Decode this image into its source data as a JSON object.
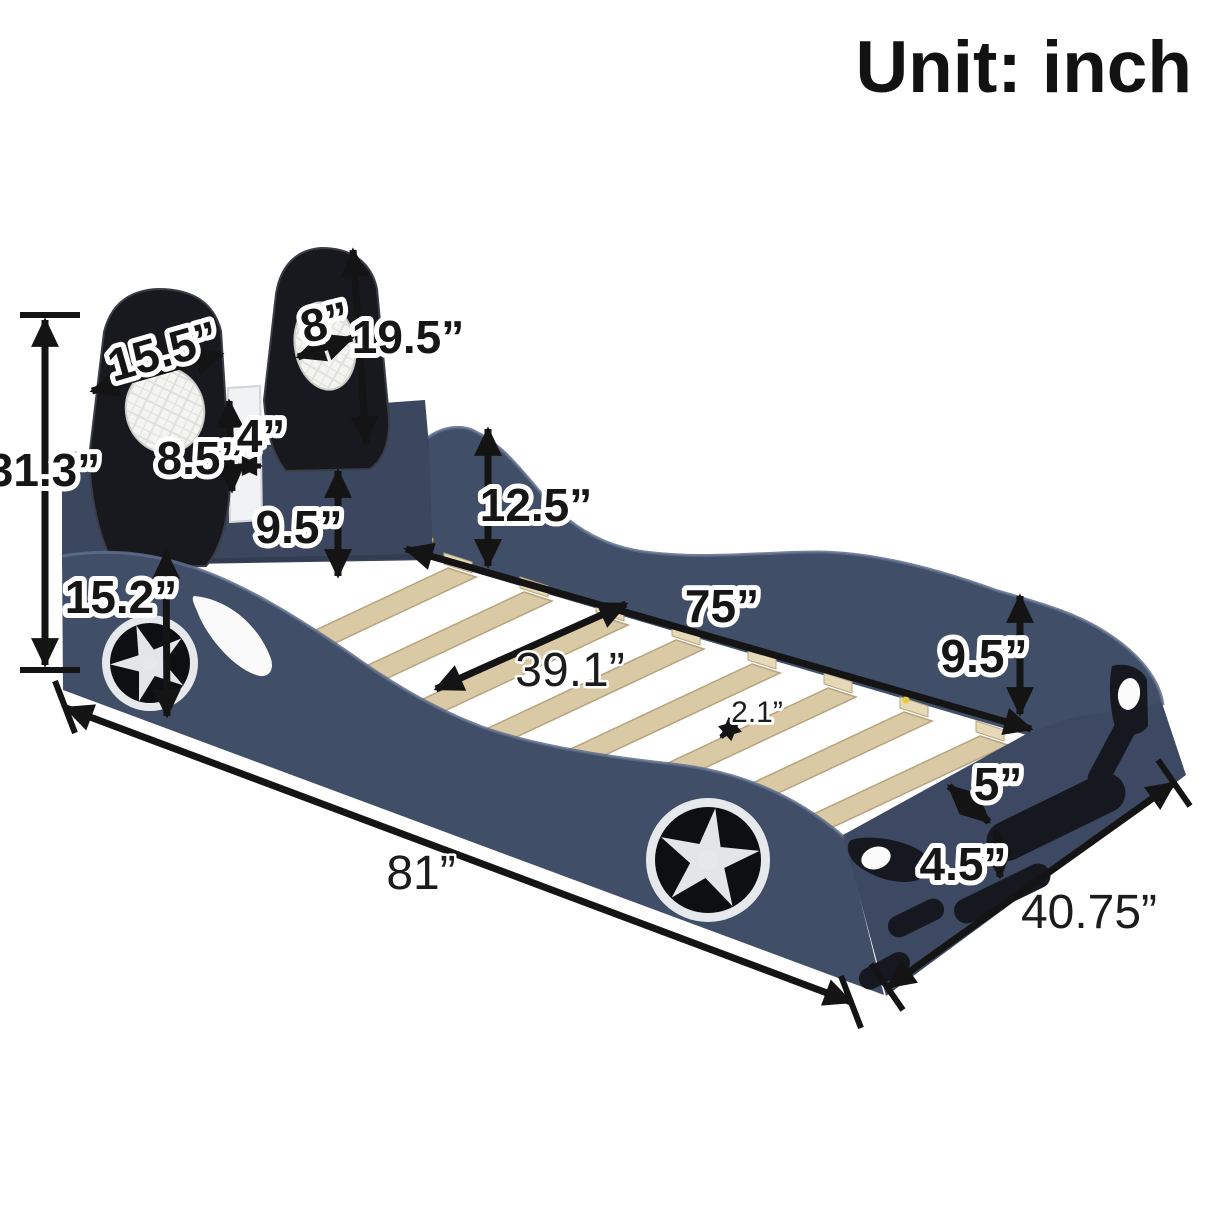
{
  "unit": {
    "label": "Unit: inch"
  },
  "colors": {
    "navy": "#414e68",
    "navyDark": "#39455e",
    "navyHead": "#3b475f",
    "navyFoot": "#3d4962",
    "railEdge": "#5f6e8c",
    "seatBlack": "#17191f",
    "slat": "#d9c9a5",
    "slatEdge": "#b7a47d",
    "cleat": "#e6d9b8",
    "wheelRim": "#e6e9ec"
  },
  "dims": {
    "seat_back_width": "15.5”",
    "cushion_width": "8”",
    "seat_back_height": "19.5”",
    "seat_lower_height": "8.5”",
    "seat_gap": "4”",
    "overall_height": "31.3”",
    "front_side_height": "15.2”",
    "side_rail_inner_height": "9.5”",
    "headboard_wall_height": "12.5”",
    "interior_length": "75”",
    "interior_width": "39.1”",
    "slat_gap": "2.1”",
    "foot_rail_inner_height": "9.5”",
    "bumper_top_offset": "5”",
    "bumper_height": "4.5”",
    "overall_length": "81”",
    "overall_width": "40.75”"
  }
}
